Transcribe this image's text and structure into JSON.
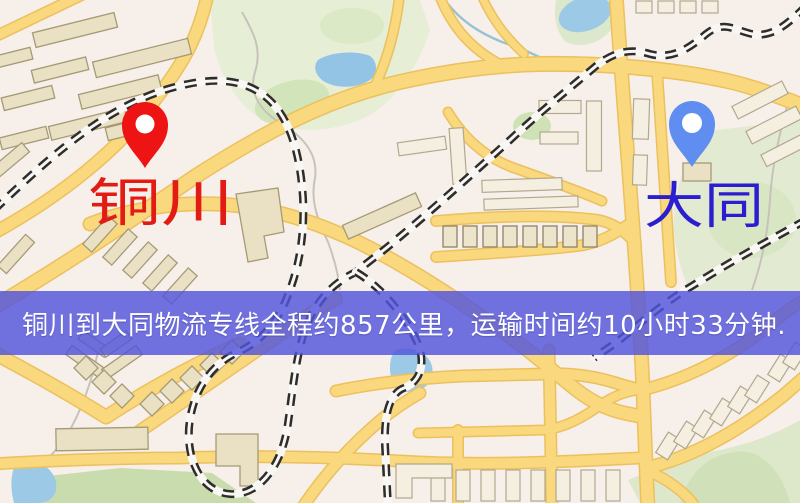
{
  "map": {
    "origin": {
      "label": "铜川",
      "pin_color": "#ee1414",
      "label_color": "#e21b14"
    },
    "destination": {
      "label": "大同",
      "pin_color": "#5f8ef0",
      "label_color": "#2a1ed0"
    },
    "style_colors": {
      "background": "#f7f0ea",
      "road": "#f9d87e",
      "park_green": "#e4ecd4",
      "water_blue": "#9ccae6",
      "railway_dark": "#2e2d2b"
    }
  },
  "banner": {
    "text": "铜川到大同物流专线全程约857公里，运输时间约10小时33分钟.",
    "background_color": "#5254dd",
    "text_color": "#ffffff"
  },
  "route": {
    "origin": "铜川",
    "destination": "大同",
    "distance_text": "857公里",
    "duration_text": "10小时33分钟"
  }
}
